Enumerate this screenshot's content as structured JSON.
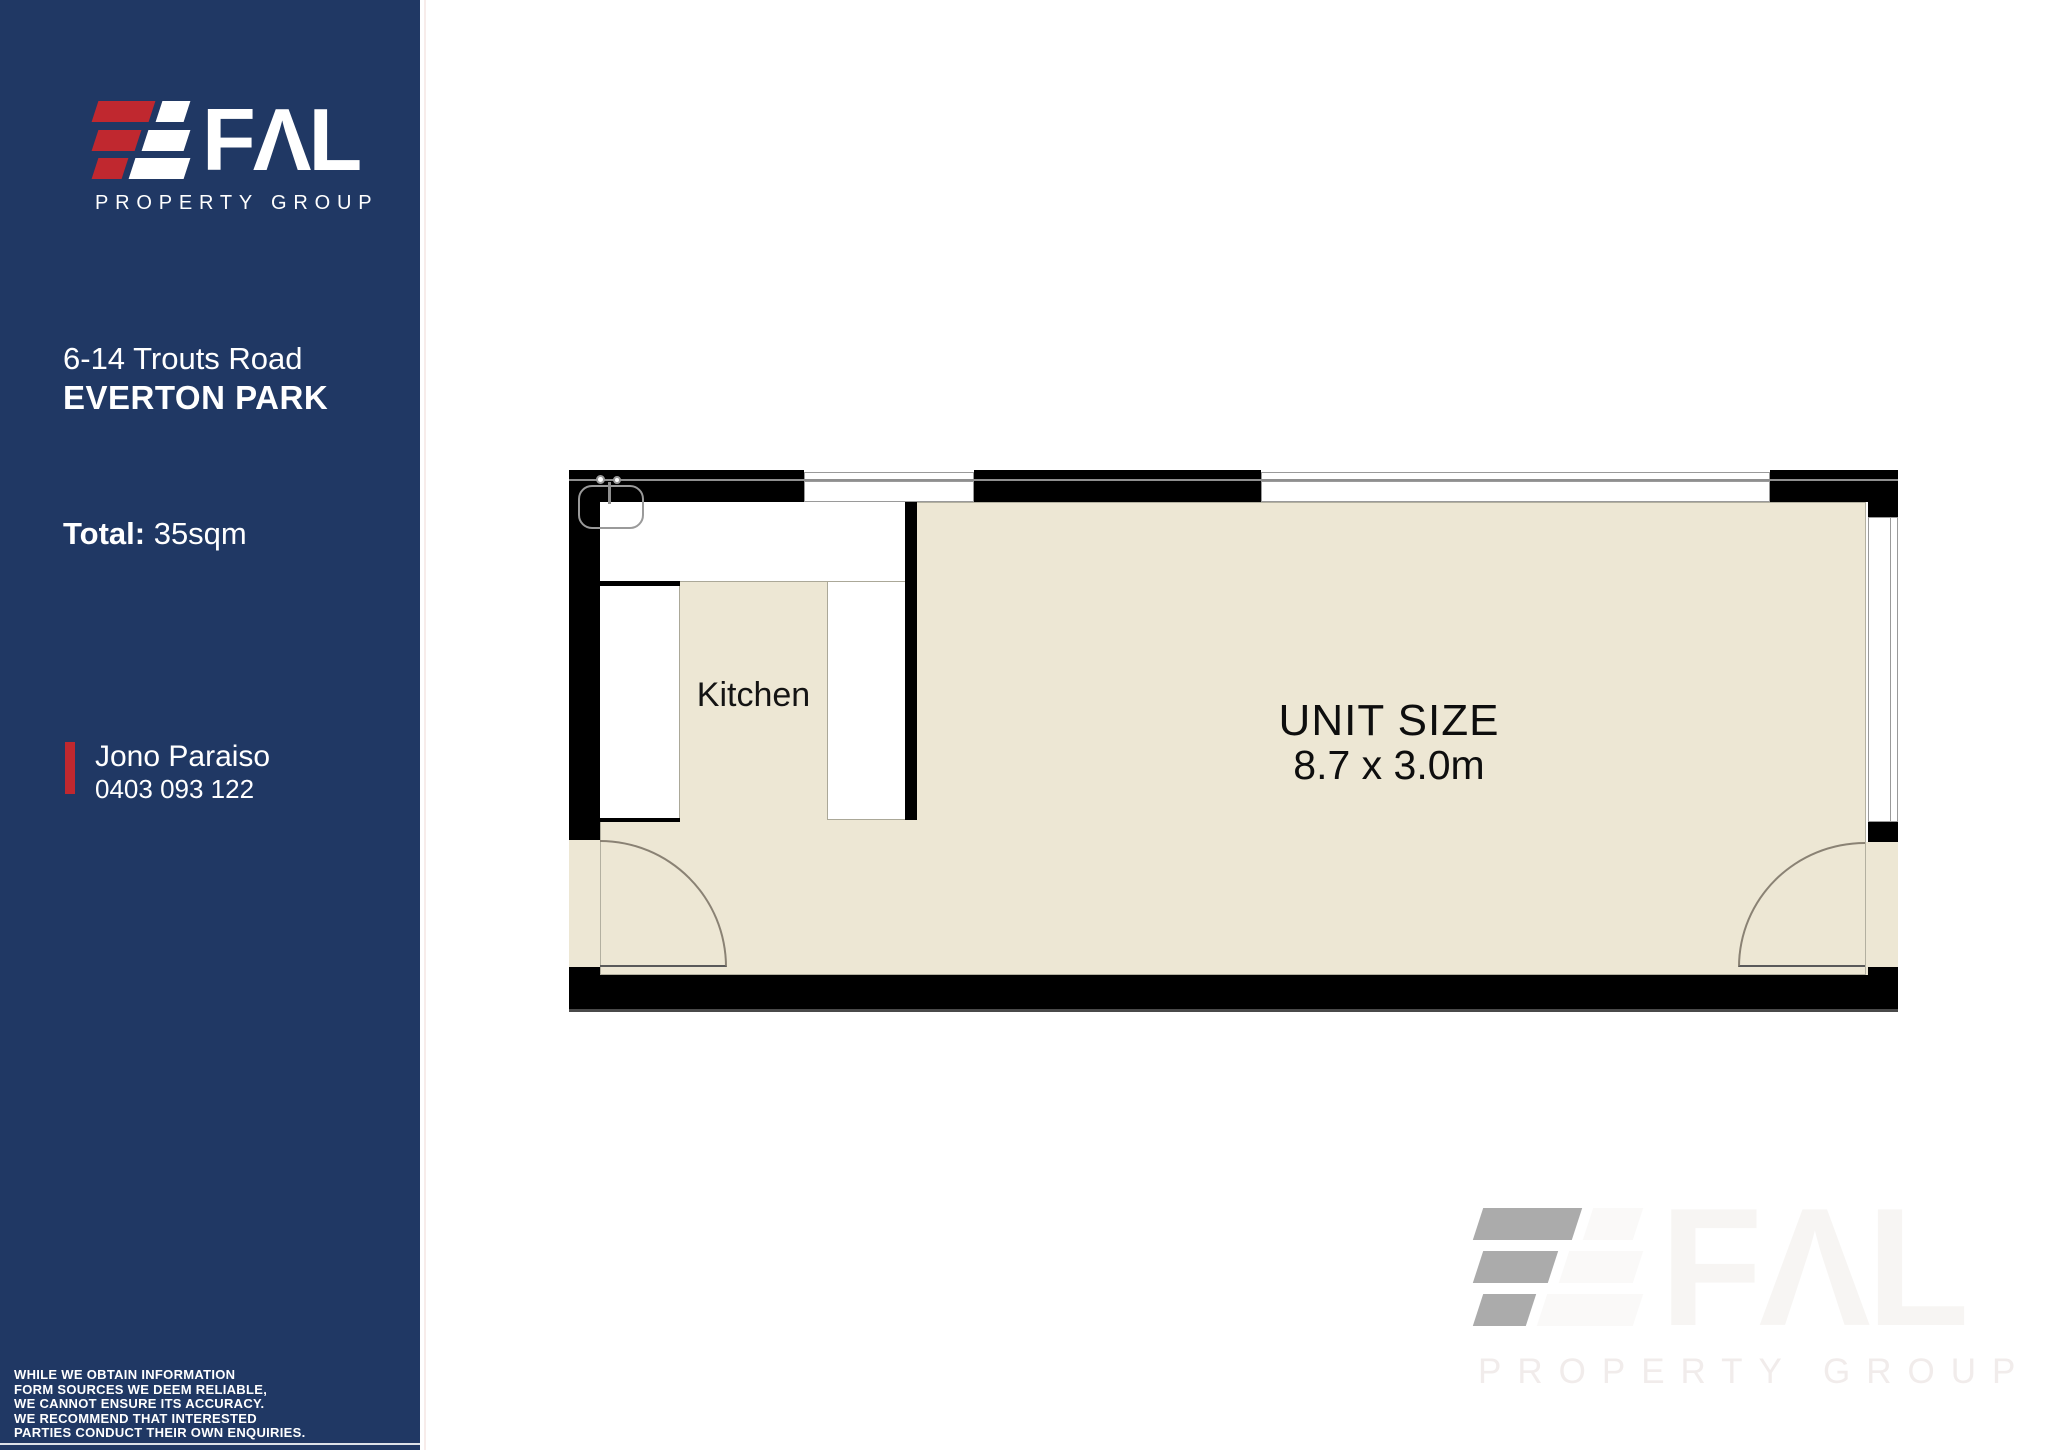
{
  "brand": {
    "wordmark": "FΛL",
    "tagline": "PROPERTY GROUP",
    "navy": "#203864",
    "red": "#C0282F"
  },
  "sidebar": {
    "address_line1": "6-14 Trouts Road",
    "address_line2": "EVERTON PARK",
    "total_label": "Total:",
    "total_value": "35sqm",
    "agent": {
      "name": "Jono Paraiso",
      "phone": "0403 093 122"
    },
    "disclaimer_lines": [
      "WHILE WE OBTAIN INFORMATION",
      "FORM SOURCES WE DEEM RELIABLE,",
      "WE CANNOT ENSURE ITS ACCURACY.",
      "WE RECOMMEND THAT INTERESTED",
      "PARTIES CONDUCT THEIR OWN ENQUIRIES."
    ]
  },
  "floorplan": {
    "labels": {
      "kitchen": "Kitchen",
      "unit_size_title": "UNIT SIZE",
      "unit_size_dims": "8.7 x 3.0m"
    },
    "floor_color": "#EDE7D4",
    "wall_color": "#000000"
  },
  "watermark": {
    "wordmark": "FΛL",
    "tagline": "PROPERTY GROUP"
  }
}
